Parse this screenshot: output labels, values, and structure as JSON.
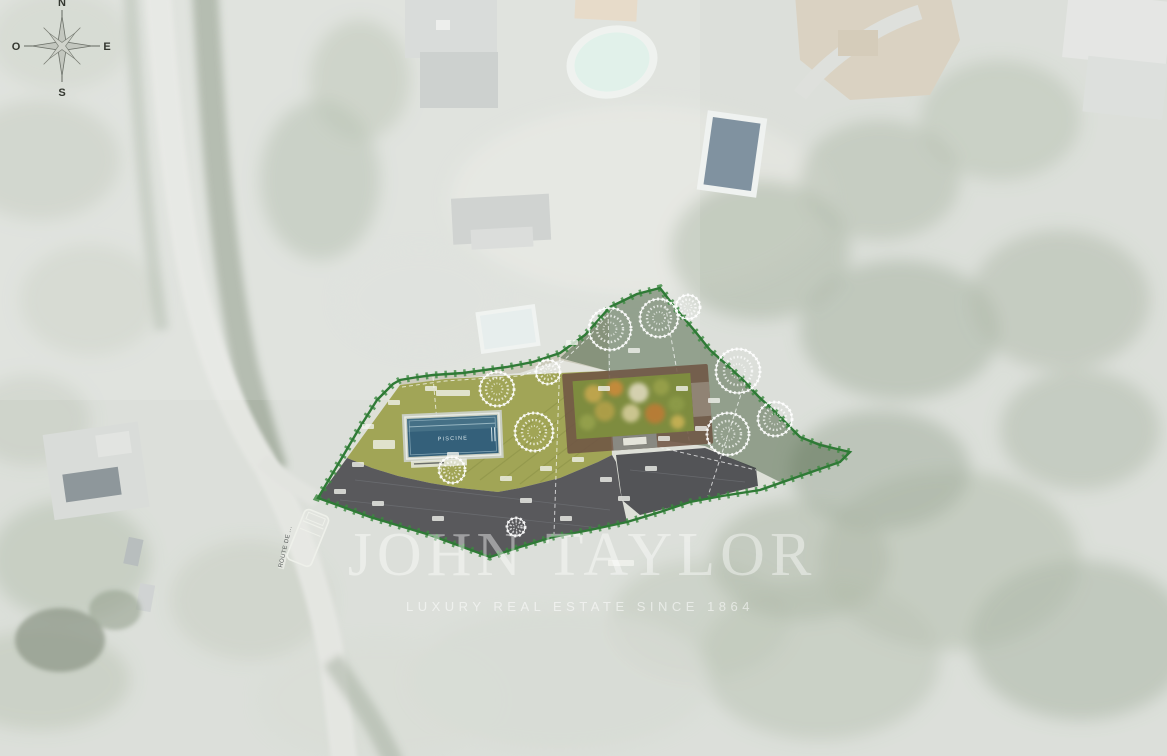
{
  "compass": {
    "n": "N",
    "e": "E",
    "s": "S",
    "o": "O"
  },
  "watermark": {
    "brand": "JOHN TAYLOR",
    "tagline": "LUXURY REAL ESTATE SINCE 1864"
  },
  "plan": {
    "pool_label": "PISCINE"
  },
  "road": {
    "label": "ROUTE DE ..."
  },
  "colors": {
    "boundary_green": "#2f7a36",
    "lawn_green": "#9ba04b",
    "pool_water": "#34607a",
    "driveway_dark": "#45464a",
    "terrace_brown": "#705544",
    "satellite_base": "#cdd2ca",
    "watermark_white": "#ffffff"
  }
}
